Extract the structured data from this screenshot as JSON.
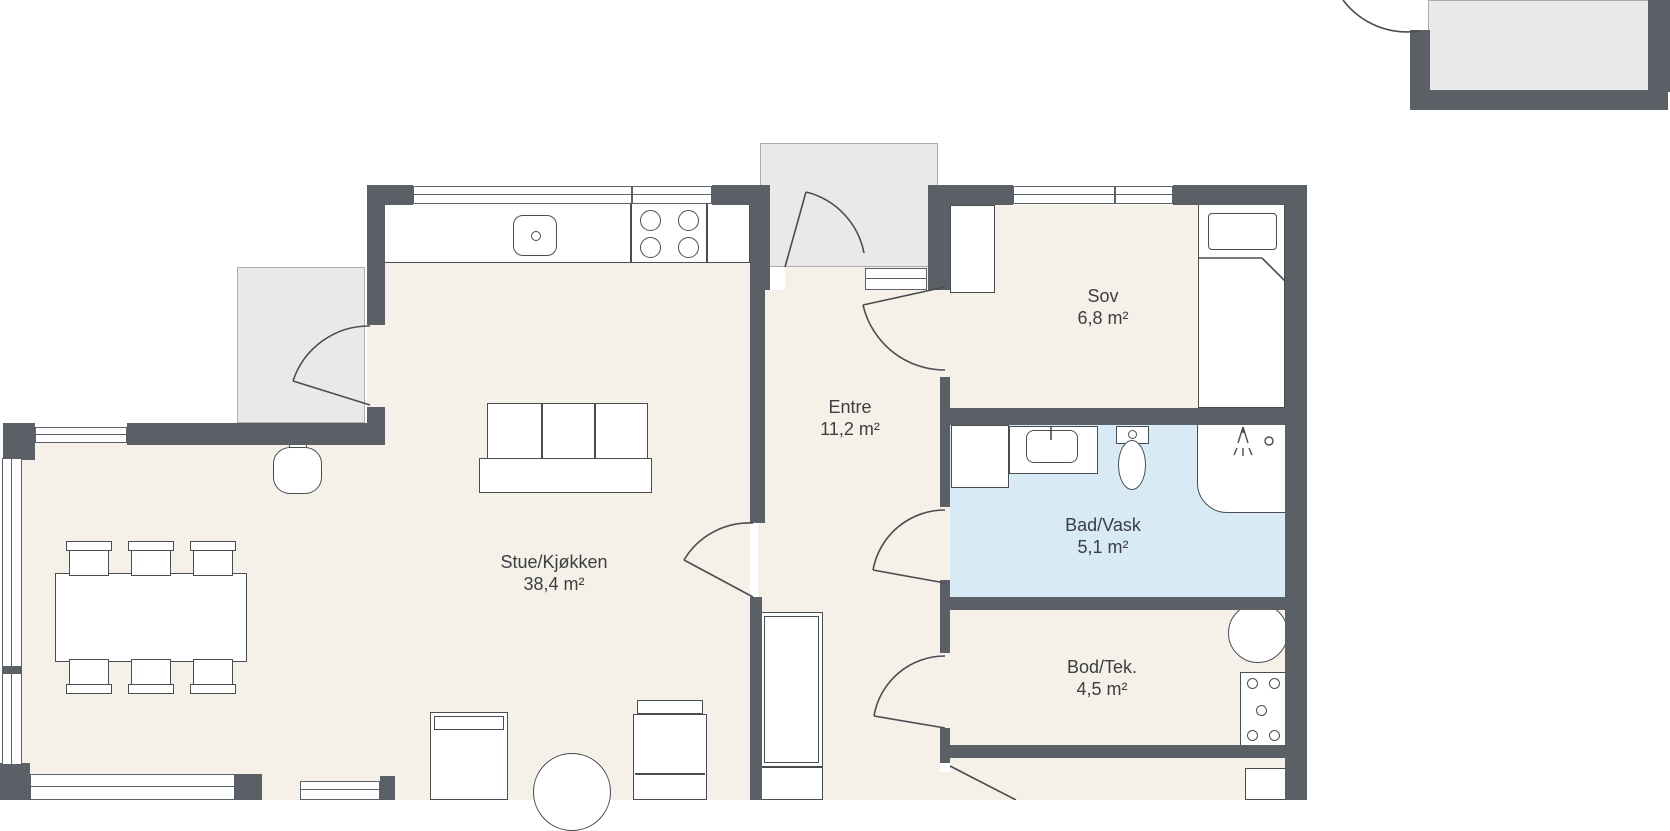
{
  "rooms": [
    {
      "id": "stue-kjokken",
      "name": "Stue/Kjøkken",
      "area": "38,4 m²"
    },
    {
      "id": "entre",
      "name": "Entre",
      "area": "11,2 m²"
    },
    {
      "id": "sov",
      "name": "Sov",
      "area": "6,8 m²"
    },
    {
      "id": "bad-vask",
      "name": "Bad/Vask",
      "area": "5,1 m²"
    },
    {
      "id": "bod-tek",
      "name": "Bod/Tek.",
      "area": "4,5 m²"
    }
  ],
  "colors": {
    "wall": "#5a6065",
    "outline_dark": "#4a4d50",
    "floor_beige": "#f5f1e8",
    "bathroom_blue": "#d9eaf7",
    "outdoor_gray": "#e9e9e9",
    "label_text": "#3b3e42"
  }
}
